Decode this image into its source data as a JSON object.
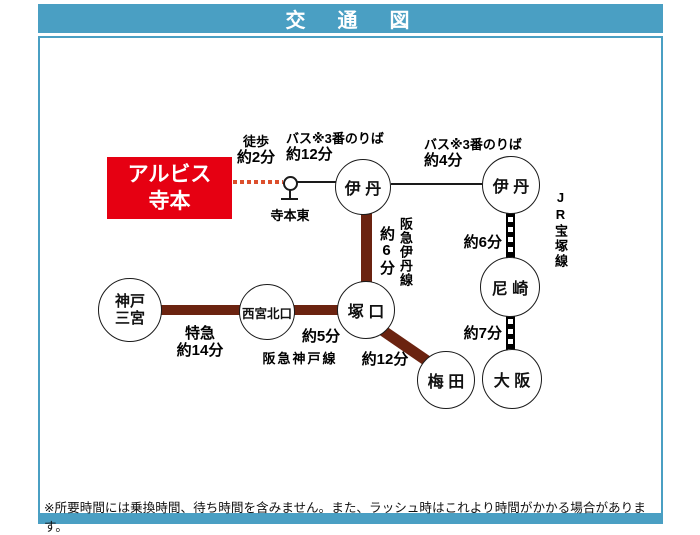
{
  "title": "交　通　図",
  "colors": {
    "header_teal": "#4A9FC3",
    "origin_red": "#E60012",
    "hankyu_brown": "#6B2310",
    "walk_dotted_orange": "#DC4F2D"
  },
  "origin": {
    "name_line1": "アルビス",
    "name_line2": "寺本",
    "walk_line1": "徒歩",
    "walk_line2": "約2分",
    "bus_stop": "寺本東"
  },
  "labels": {
    "bus1_line1": "バス※3番のりば",
    "bus1_line2": "約12分",
    "bus2_line1": "バス※3番のりば",
    "bus2_line2": "約4分",
    "jr_takarazuka_line": "JR宝塚線",
    "jr_itami_amagasaki_time": "約6分",
    "jr_amagasaki_osaka_time": "約7分",
    "hankyu_itami_line": "阪急伊丹線",
    "hankyu_itami_time": "約6分",
    "hankyu_kobe_line": "阪急神戸線",
    "express_line1": "特急",
    "express_line2": "約14分",
    "nishikita_tsukaguchi_time": "約5分",
    "tsukaguchi_umeda_time": "約12分"
  },
  "stations": {
    "itami_hankyu": "伊 丹",
    "itami_jr": "伊 丹",
    "amagasaki": "尼 崎",
    "tsukaguchi": "塚 口",
    "nishinomiya_kitaguchi": "西宮北口",
    "kobe_sannomiya_line1": "神戸",
    "kobe_sannomiya_line2": "三宮",
    "umeda": "梅 田",
    "osaka": "大 阪"
  },
  "footer": {
    "note": "※所要時間には乗換時間、待ち時間を含みません。また、ラッシュ時はこれより時間がかかる場合があります。"
  }
}
